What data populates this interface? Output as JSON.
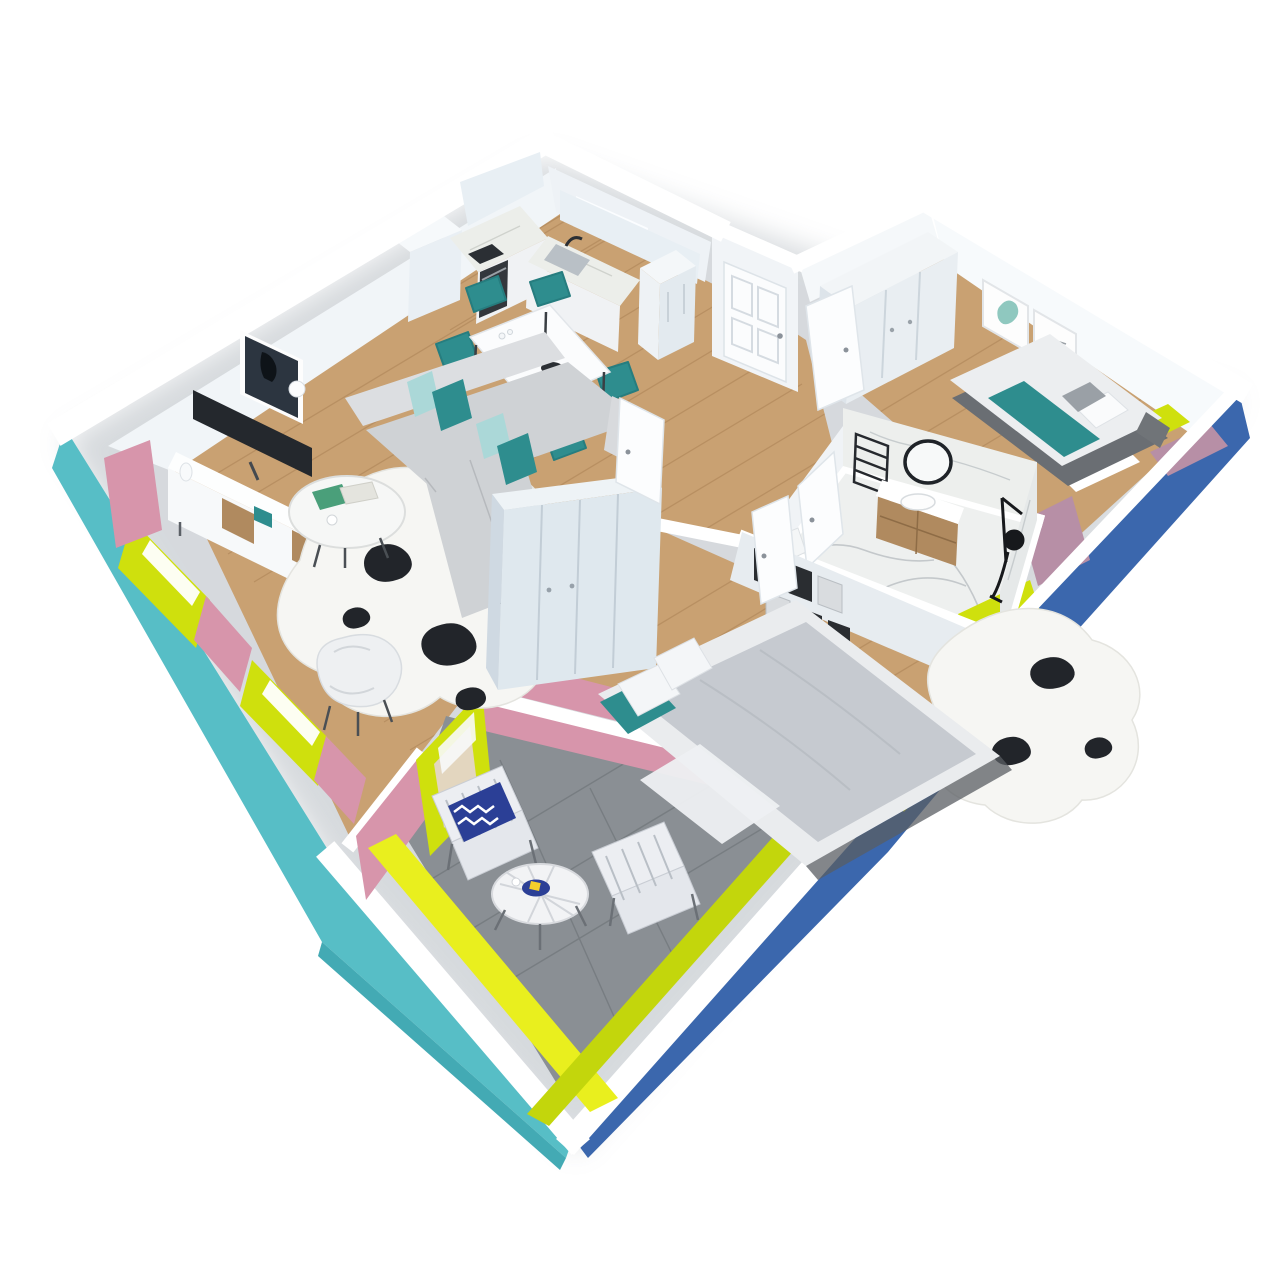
{
  "scene": {
    "type": "isometric-3d-apartment-floor-plan-render",
    "background": "#ffffff"
  },
  "palette": {
    "wall_top": "#ffffff",
    "wall_light": "#f2f5f8",
    "wall_shade": "#e7ecf0",
    "exterior_teal": "#57bec6",
    "exterior_blue": "#3b67ad",
    "accent_lime": "#cfe00d",
    "accent_yellow": "#e9ef1e",
    "accent_pink": "#d795ab",
    "accent_mauve": "#b78fa6",
    "floor_wood": "#c9a172",
    "floor_wood_line": "#a87f52",
    "floor_concrete": "#8a8f94",
    "floor_marble": "#eef0ef",
    "furniture_white": "#f1f3f5",
    "sofa_gray": "#cfd2d5",
    "sofa_gray_light": "#dcdee1",
    "duvet_gray": "#c6cad0",
    "teal_fabric": "#2e8d8e",
    "teal_light": "#abd8d8",
    "wood_furniture": "#b08a5f",
    "dark": "#26292e",
    "navy": "#2b3f96",
    "rug_white": "#f6f6f3",
    "shadow": "#9aa3ab"
  }
}
